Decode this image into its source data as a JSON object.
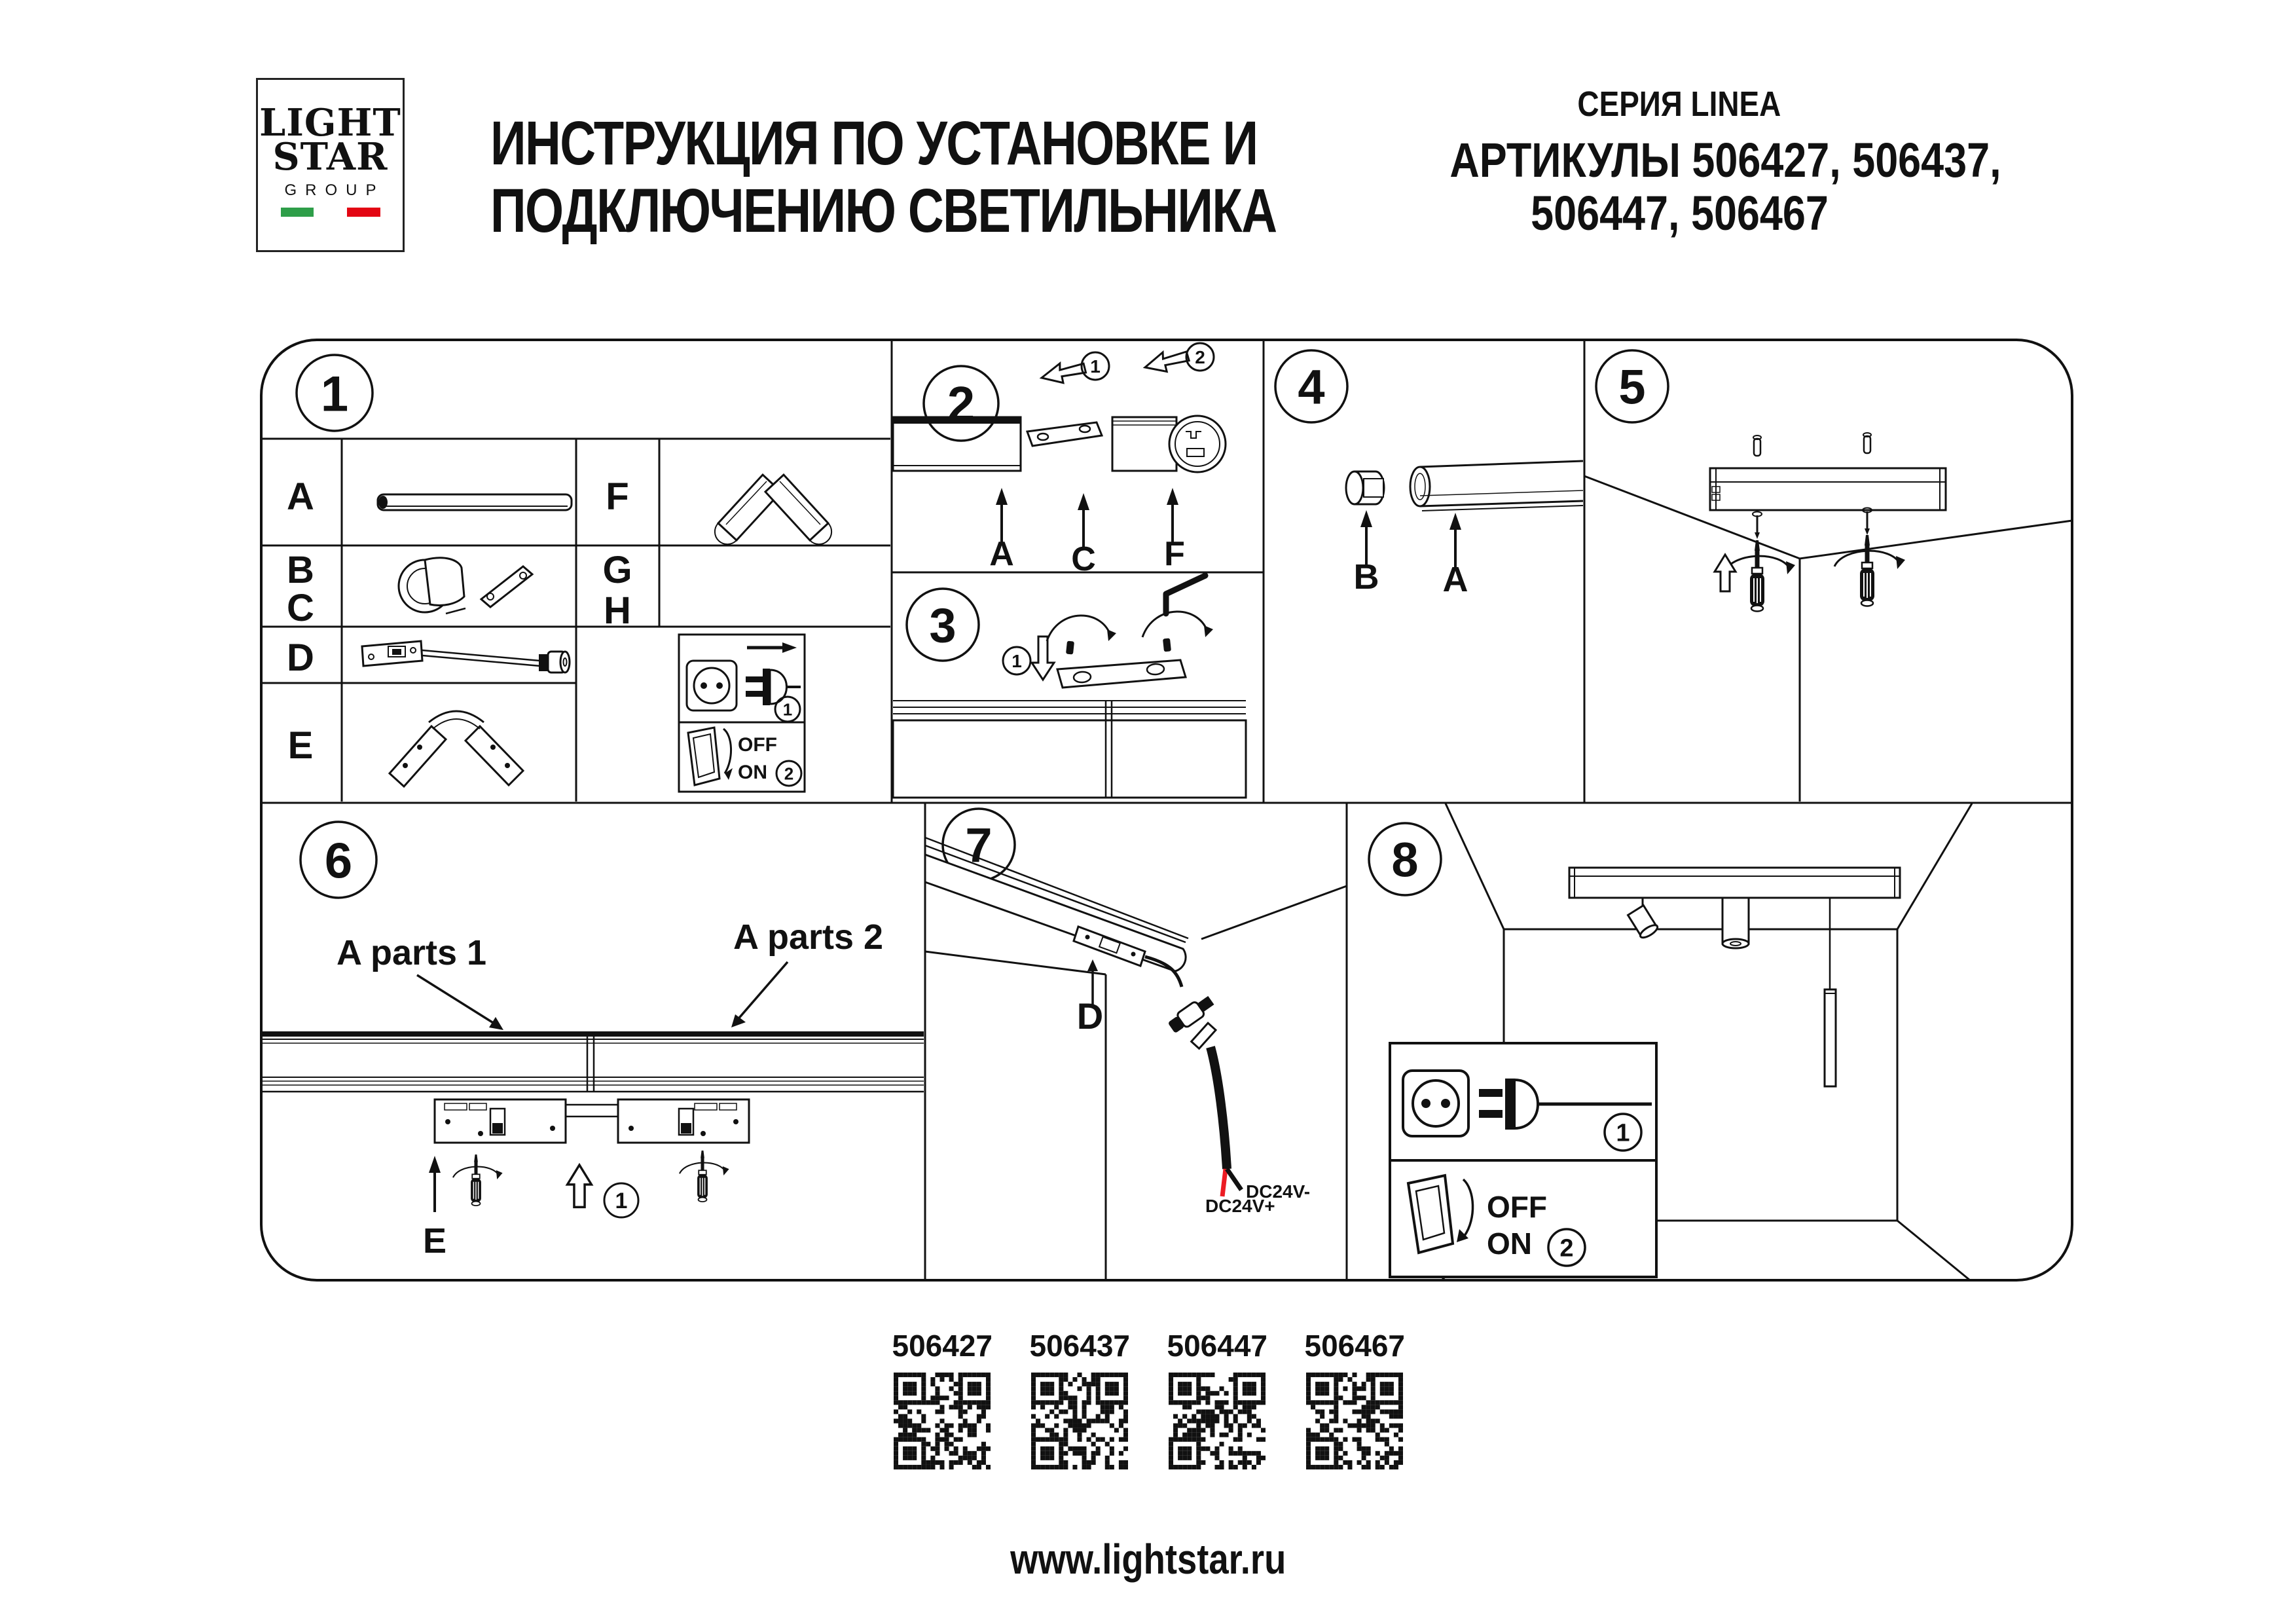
{
  "header": {
    "logo_line1": "LIGHT",
    "logo_line2": "STAR",
    "logo_line3": "GROUP",
    "title_line1": "ИНСТРУКЦИЯ ПО УСТАНОВКЕ И",
    "title_line2": "ПОДКЛЮЧЕНИЮ СВЕТИЛЬНИКА",
    "series": "СЕРИЯ LINEA",
    "articles_line1": "АРТИКУЛЫ 506427, 506437,",
    "articles_line2": "506447, 506467"
  },
  "panels": {
    "p1": {
      "number": "1",
      "row_a": "A",
      "row_b": "B",
      "row_c": "C",
      "row_d": "D",
      "row_e": "E",
      "row_f": "F",
      "row_g": "G",
      "row_h": "H",
      "off": "OFF",
      "on": "ON",
      "step_plug": "1",
      "step_switch": "2"
    },
    "p2": {
      "number": "2",
      "step1": "1",
      "step2": "2",
      "label_a": "A",
      "label_c": "C",
      "label_f": "F"
    },
    "p3": {
      "number": "3",
      "step1": "1"
    },
    "p4": {
      "number": "4",
      "label_b": "B",
      "label_a": "A"
    },
    "p5": {
      "number": "5"
    },
    "p6": {
      "number": "6",
      "parts1": "A parts 1",
      "parts2": "A parts 2",
      "label_e": "E",
      "step1": "1"
    },
    "p7": {
      "number": "7",
      "label_d": "D",
      "wire_neg": "DC24V-",
      "wire_pos": "DC24V+"
    },
    "p8": {
      "number": "8",
      "off": "OFF",
      "on": "ON",
      "step1": "1",
      "step2": "2"
    }
  },
  "footer": {
    "qr_codes": [
      "506427",
      "506437",
      "506447",
      "506467"
    ],
    "url": "www.lightstar.ru"
  },
  "colors": {
    "ink": "#111111",
    "flag_green": "#2e9e49",
    "flag_red": "#e30613",
    "wire_red": "#ec1c24"
  }
}
